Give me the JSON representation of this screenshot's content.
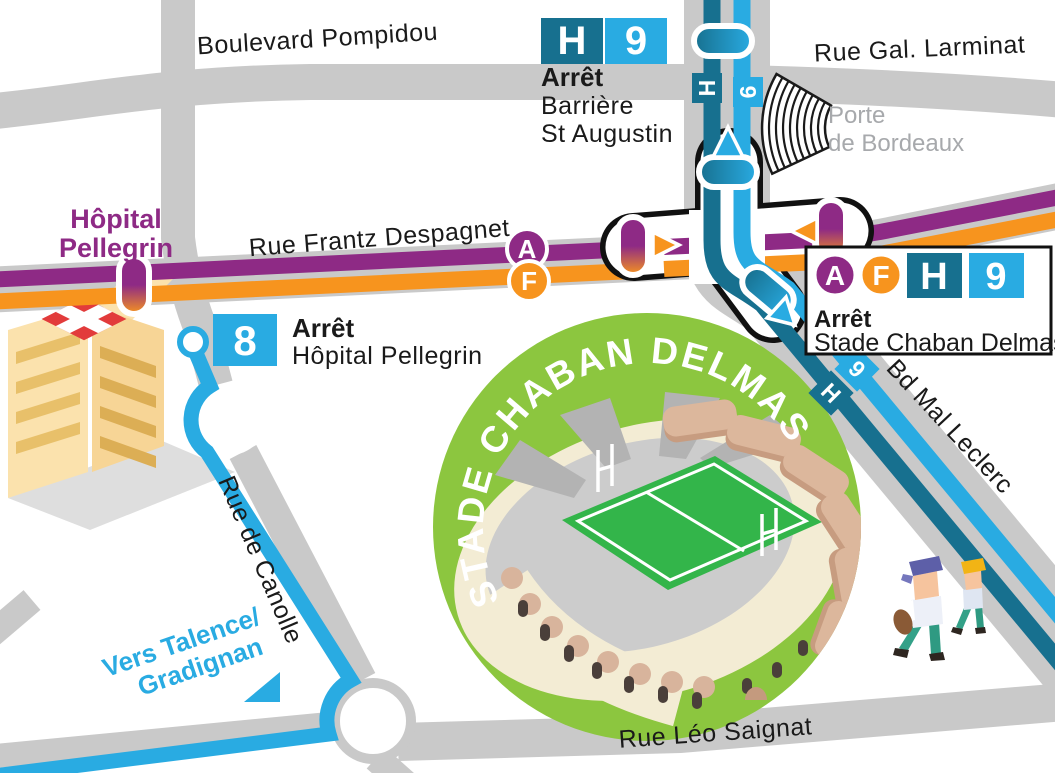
{
  "title": "Stade Chaban Delmas — plan d'accès",
  "colors": {
    "line_a_purple": "#8E2A85",
    "line_f_orange": "#F7941E",
    "line_h_teal": "#17708F",
    "line_9_blue": "#29ABE2",
    "line_8_blue": "#29ABE2",
    "stadium_green": "#8CC63F",
    "road_gray": "#C9C9C9",
    "muted_text_gray": "#A7A9AC"
  },
  "streets": {
    "boulevard_pompidou": "Boulevard Pompidou",
    "rue_gal_larminat": "Rue Gal. Larminat",
    "rue_frantz_despagnet": "Rue Frantz Despagnet",
    "rue_de_canolle": "Rue de Canolle",
    "rue_leo_saignat": "Rue Léo Saignat",
    "bd_mal_leclerc": "Bd Mal Leclerc"
  },
  "places": {
    "porte_de_bordeaux_line1": "Porte",
    "porte_de_bordeaux_line2": "de Bordeaux",
    "hopital_line1": "Hôpital",
    "hopital_line2": "Pellegrin",
    "stadium_ring": "STADE CHABAN DELMAS"
  },
  "direction_sign": {
    "line1": "Vers Talence/",
    "line2": "Gradignan"
  },
  "lines": {
    "a": "A",
    "f": "F",
    "h": "H",
    "nine": "9",
    "eight": "8"
  },
  "stops": {
    "barriere": {
      "label": "Arrêt",
      "name1": "Barrière",
      "name2": "St Augustin"
    },
    "pellegrin": {
      "label": "Arrêt",
      "name": "Hôpital Pellegrin"
    },
    "chaban": {
      "label": "Arrêt",
      "name": "Stade Chaban Delmas"
    }
  }
}
